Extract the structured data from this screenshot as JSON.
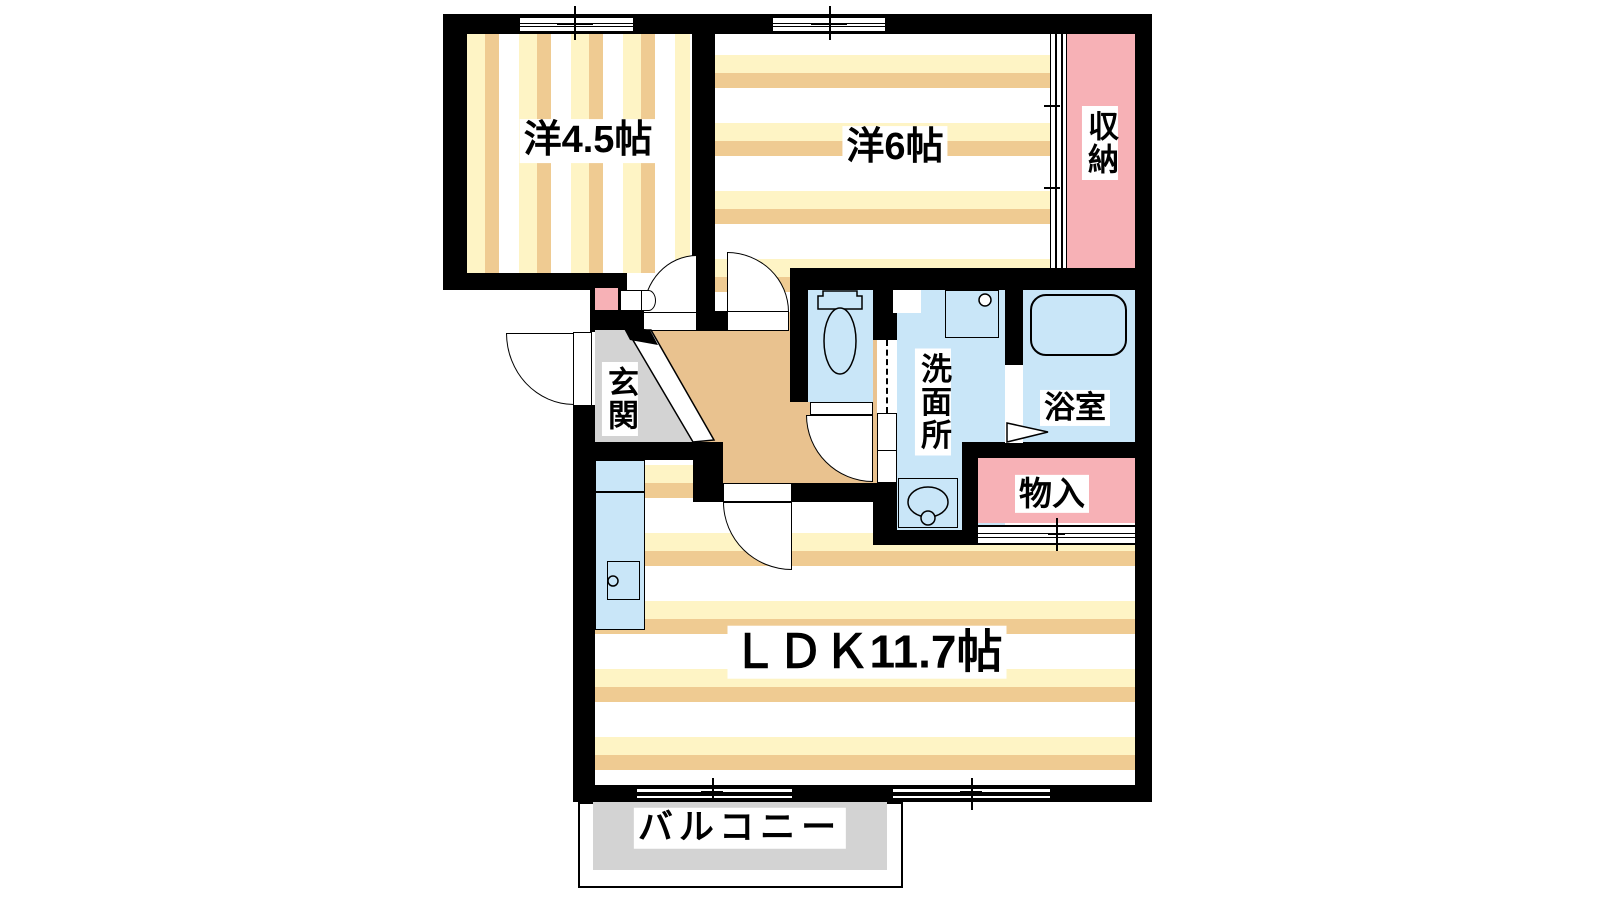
{
  "image_type": "apartment-floor-plan",
  "rooms": {
    "western45": {
      "label": "洋4.5帖"
    },
    "western6": {
      "label": "洋6帖"
    },
    "closet": {
      "label": "収納"
    },
    "entrance": {
      "label": "玄関"
    },
    "washroom": {
      "label": "洗面所"
    },
    "bathroom": {
      "label": "浴室"
    },
    "storage": {
      "label": "物入"
    },
    "ldk": {
      "label": "ＬＤＫ11.7帖"
    },
    "balcony": {
      "label": "バルコニー"
    }
  },
  "colors": {
    "wall": "#000000",
    "stripe_yellow": "#FEF4C5",
    "stripe_tan": "#EFCB92",
    "closet_pink": "#F7B1B6",
    "wet_area_blue": "#C9E6F8",
    "hallway_tan": "#E9C28F",
    "entrance_gray": "#D3D3D3",
    "balcony_gray": "#D3D3D3"
  }
}
